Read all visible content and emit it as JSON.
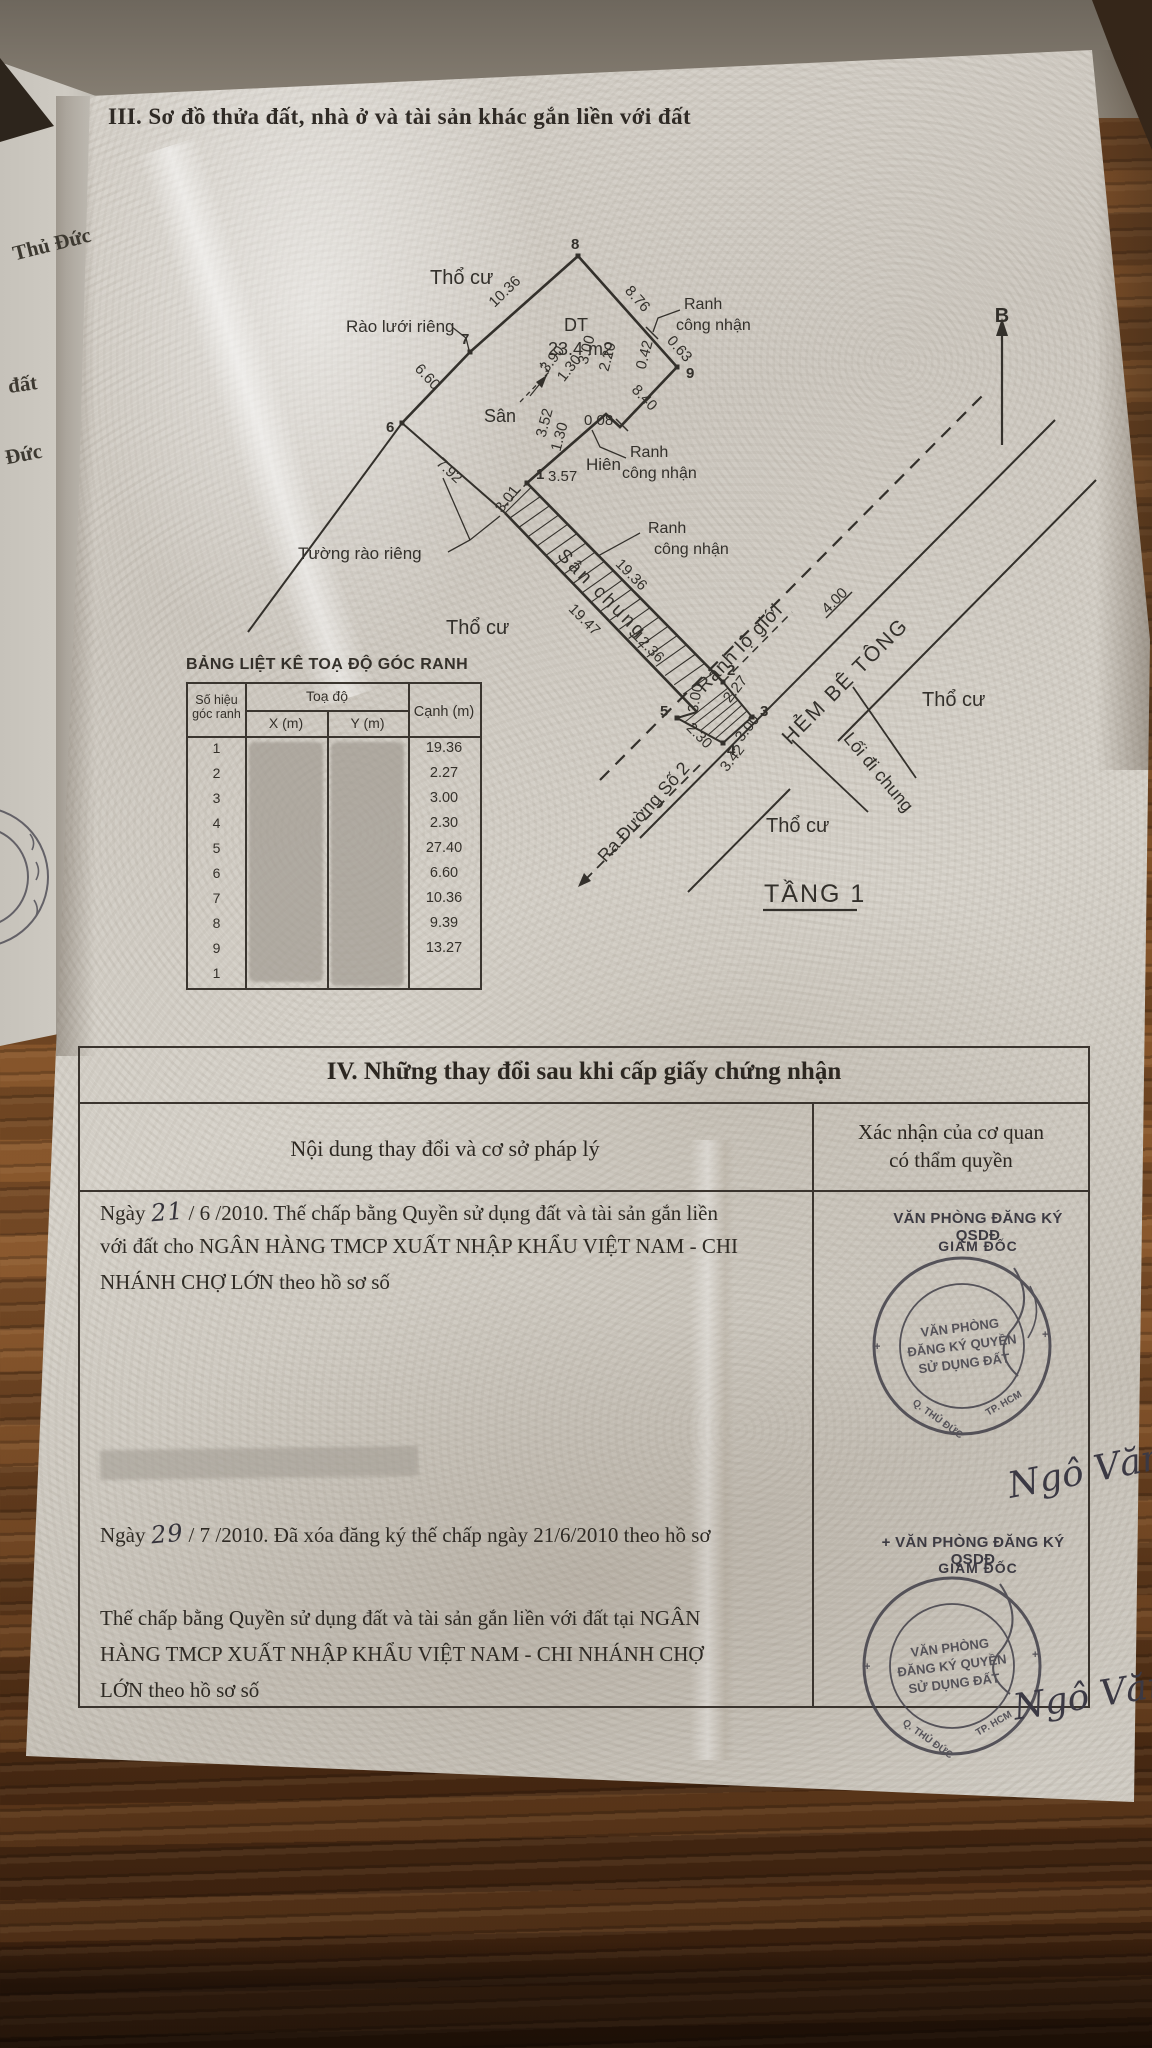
{
  "colors": {
    "ink": "#33302b",
    "paper": "#d6d2ca",
    "stamp_ink": "#45434c",
    "wood": "#7a4a28"
  },
  "section3": {
    "title": "III. Sơ đồ thửa đất, nhà ở và tài sản khác gắn liền với đất"
  },
  "margin": {
    "items": [
      {
        "t": "Thủ Đức"
      },
      {
        "t": "đất"
      },
      {
        "t": "Đức"
      }
    ]
  },
  "diagram": {
    "solid": [
      {
        "p": [
          [
            402,
            423
          ],
          [
            470,
            352
          ],
          [
            578,
            256
          ],
          [
            677,
            367
          ]
        ],
        "w": 2.6
      },
      {
        "p": [
          [
            677,
            367
          ],
          [
            620,
            427
          ],
          [
            606,
            414
          ],
          [
            527,
            483
          ]
        ],
        "w": 2.6
      },
      {
        "p": [
          [
            402,
            423
          ],
          [
            248,
            632
          ]
        ],
        "w": 2
      },
      {
        "p": [
          [
            402,
            423
          ],
          [
            505,
            513
          ]
        ],
        "w": 2
      },
      {
        "p": [
          [
            527,
            483
          ],
          [
            723,
            682
          ]
        ],
        "w": 2.6
      },
      {
        "p": [
          [
            505,
            513
          ],
          [
            697,
            712
          ]
        ],
        "w": 2.6
      },
      {
        "p": [
          [
            723,
            682
          ],
          [
            752,
            717
          ],
          [
            723,
            743
          ],
          [
            677,
            718
          ],
          [
            697,
            712
          ]
        ],
        "w": 2
      },
      {
        "p": [
          [
            640,
            838
          ],
          [
            1055,
            420
          ]
        ],
        "w": 2
      },
      {
        "p": [
          [
            688,
            892
          ],
          [
            790,
            789
          ]
        ],
        "w": 2
      },
      {
        "p": [
          [
            838,
            741
          ],
          [
            1096,
            480
          ]
        ],
        "w": 2
      },
      {
        "p": [
          [
            853,
            687
          ],
          [
            916,
            778
          ]
        ],
        "w": 1.8
      },
      {
        "p": [
          [
            792,
            740
          ],
          [
            868,
            812
          ]
        ],
        "w": 1.8
      },
      {
        "p": [
          [
            763,
            910
          ],
          [
            857,
            910
          ]
        ],
        "w": 2.2
      },
      {
        "p": [
          [
            646,
            327
          ],
          [
            658,
            339
          ]
        ],
        "w": 1.5
      },
      {
        "p": [
          [
            616,
            419
          ],
          [
            628,
            431
          ]
        ],
        "w": 1.5
      },
      {
        "p": [
          [
            826,
            618
          ],
          [
            852,
            592
          ]
        ],
        "w": 1.5
      },
      {
        "p": [
          [
            452,
            327
          ],
          [
            466,
            338
          ],
          [
            469,
            350
          ]
        ],
        "w": 1.3
      },
      {
        "p": [
          [
            448,
            552
          ],
          [
            470,
            540
          ],
          [
            500,
            516
          ]
        ],
        "w": 1.3
      },
      {
        "p": [
          [
            470,
            540
          ],
          [
            443,
            478
          ]
        ],
        "w": 1.3
      },
      {
        "p": [
          [
            680,
            310
          ],
          [
            658,
            318
          ],
          [
            653,
            332
          ]
        ],
        "w": 1.3
      },
      {
        "p": [
          [
            626,
            458
          ],
          [
            600,
            447
          ],
          [
            592,
            430
          ]
        ],
        "w": 1.3
      },
      {
        "p": [
          [
            640,
            533
          ],
          [
            598,
            556
          ],
          [
            586,
            544
          ]
        ],
        "w": 1.3
      },
      {
        "p": [
          [
            1002,
            445
          ],
          [
            1002,
            330
          ]
        ],
        "w": 2.2
      },
      {
        "p": [
          [
            530,
            396
          ],
          [
            547,
            375
          ]
        ],
        "w": 1.2
      },
      {
        "p": [
          [
            728,
            688
          ],
          [
            685,
            722
          ]
        ],
        "w": 1.1
      },
      {
        "p": [
          [
            733,
            694
          ],
          [
            692,
            726
          ]
        ],
        "w": 1.1
      },
      {
        "p": [
          [
            738,
            700
          ],
          [
            700,
            731
          ]
        ],
        "w": 1.1
      },
      {
        "p": [
          [
            742,
            705
          ],
          [
            708,
            735
          ]
        ],
        "w": 1.1
      },
      {
        "p": [
          [
            747,
            711
          ],
          [
            715,
            739
          ]
        ],
        "w": 1.1
      }
    ],
    "dashed": [
      {
        "p": [
          [
            600,
            780
          ],
          [
            985,
            393
          ]
        ],
        "w": 2.2,
        "d": "13 9"
      },
      {
        "p": [
          [
            585,
            880
          ],
          [
            700,
            765
          ]
        ],
        "w": 1.8,
        "d": "10 7"
      },
      {
        "p": [
          [
            723,
            682
          ],
          [
            792,
            612
          ]
        ],
        "w": 1.5,
        "d": "8 6"
      },
      {
        "p": [
          [
            520,
            402
          ],
          [
            549,
            372
          ]
        ],
        "w": 1.3,
        "d": "5 4"
      },
      {
        "p": [
          [
            549,
            372
          ],
          [
            540,
            363
          ]
        ],
        "w": 1.3,
        "d": "5 4"
      },
      {
        "p": [
          [
            527,
            483
          ],
          [
            503,
            508
          ]
        ],
        "w": 1.5,
        "d": "5 4"
      }
    ],
    "arrows": [
      [
        [
          1002,
          318
        ],
        [
          996,
          336
        ],
        [
          1008,
          336
        ]
      ],
      [
        [
          578,
          887
        ],
        [
          591,
          881
        ],
        [
          584,
          873
        ]
      ],
      [
        [
          547,
          375
        ],
        [
          542,
          388
        ],
        [
          536,
          382
        ]
      ]
    ],
    "hatch": {
      "upper": [
        527,
        483
      ],
      "lower": [
        505,
        513
      ],
      "dir": [
        0.702,
        0.713
      ],
      "start": 6,
      "end": 272,
      "step": 13,
      "skew": 12,
      "w": 1.1
    },
    "points": [
      [
        527,
        483
      ],
      [
        723,
        682
      ],
      [
        752,
        717
      ],
      [
        723,
        743
      ],
      [
        677,
        718
      ],
      [
        402,
        423
      ],
      [
        470,
        352
      ],
      [
        578,
        256
      ],
      [
        677,
        367
      ]
    ],
    "labels": [
      {
        "t": "Thổ cư",
        "x": 430,
        "y": 284,
        "s": 20
      },
      {
        "t": "Thổ cư",
        "x": 446,
        "y": 634,
        "s": 20
      },
      {
        "t": "Thổ cư",
        "x": 922,
        "y": 706,
        "s": 20
      },
      {
        "t": "Thổ cư",
        "x": 766,
        "y": 832,
        "s": 20
      },
      {
        "t": "Sân",
        "x": 484,
        "y": 422,
        "s": 18
      },
      {
        "t": "Hiên",
        "x": 586,
        "y": 470,
        "s": 17
      },
      {
        "t": "DT",
        "x": 564,
        "y": 331,
        "s": 18
      },
      {
        "t": "23.4 m2",
        "x": 548,
        "y": 355,
        "s": 18
      },
      {
        "t": "TẦNG 1",
        "x": 764,
        "y": 902,
        "s": 25,
        "w": 2
      },
      {
        "t": "Rào lưới riêng",
        "x": 346,
        "y": 332,
        "s": 17
      },
      {
        "t": "Tường rào riêng",
        "x": 298,
        "y": 559,
        "s": 17
      },
      {
        "t": "Ranh",
        "x": 684,
        "y": 309,
        "s": 16
      },
      {
        "t": "công nhận",
        "x": 676,
        "y": 330,
        "s": 16
      },
      {
        "t": "Ranh",
        "x": 630,
        "y": 457,
        "s": 16
      },
      {
        "t": "công nhận",
        "x": 622,
        "y": 478,
        "s": 16
      },
      {
        "t": "Ranh",
        "x": 648,
        "y": 533,
        "s": 16
      },
      {
        "t": "công nhận",
        "x": 654,
        "y": 554,
        "s": 16
      },
      {
        "t": "Ranh lộ giới",
        "x": 744,
        "y": 652,
        "s": 19,
        "r": -46,
        "a": "m",
        "w": 1
      },
      {
        "t": "HẺM BÊ TÔNG",
        "x": 850,
        "y": 686,
        "s": 21,
        "r": -45,
        "a": "m",
        "w": 2
      },
      {
        "t": "Lối đi chung",
        "x": 874,
        "y": 776,
        "s": 18,
        "r": 50,
        "a": "m"
      },
      {
        "t": "Ra Đường Số 2",
        "x": 648,
        "y": 816,
        "s": 18,
        "r": -48,
        "a": "m"
      },
      {
        "t": "Sân chung",
        "x": 598,
        "y": 598,
        "s": 19,
        "r": 45,
        "a": "m",
        "w": 3
      },
      {
        "t": "B",
        "x": 1002,
        "y": 322,
        "s": 20,
        "b": 1,
        "a": "m"
      },
      {
        "t": "10.36",
        "x": 508,
        "y": 295,
        "r": -44,
        "a": "m"
      },
      {
        "t": "8.76",
        "x": 634,
        "y": 302,
        "r": 48,
        "a": "m"
      },
      {
        "t": "0.63",
        "x": 676,
        "y": 352,
        "r": 48,
        "a": "m"
      },
      {
        "t": "6.60",
        "x": 424,
        "y": 380,
        "r": 47,
        "a": "m"
      },
      {
        "t": "7.92",
        "x": 446,
        "y": 474,
        "r": 43,
        "a": "m"
      },
      {
        "t": "8.40",
        "x": 641,
        "y": 401,
        "r": 46,
        "a": "m"
      },
      {
        "t": "0.08",
        "x": 584,
        "y": 425,
        "s": 15
      },
      {
        "t": "3.52",
        "x": 549,
        "y": 424,
        "r": -75,
        "a": "m"
      },
      {
        "t": "1.30",
        "x": 564,
        "y": 438,
        "r": -75,
        "a": "m"
      },
      {
        "t": "3.57",
        "x": 548,
        "y": 481,
        "s": 15
      },
      {
        "t": "3.01",
        "x": 511,
        "y": 502,
        "r": -52,
        "a": "m"
      },
      {
        "t": "3.90",
        "x": 556,
        "y": 362,
        "r": -52,
        "a": "m"
      },
      {
        "t": "1.30",
        "x": 573,
        "y": 371,
        "r": -52,
        "a": "m"
      },
      {
        "t": "3.00",
        "x": 591,
        "y": 351,
        "r": -75,
        "a": "m"
      },
      {
        "t": "2.20",
        "x": 612,
        "y": 358,
        "r": -75,
        "a": "m"
      },
      {
        "t": "0.42",
        "x": 649,
        "y": 356,
        "r": -75,
        "a": "m"
      },
      {
        "t": "19.36",
        "x": 628,
        "y": 578,
        "r": 45,
        "a": "m"
      },
      {
        "t": "19.47",
        "x": 581,
        "y": 623,
        "r": 45,
        "a": "m"
      },
      {
        "t": "12.36",
        "x": 645,
        "y": 650,
        "r": 45,
        "a": "m"
      },
      {
        "t": "2.27",
        "x": 739,
        "y": 692,
        "r": -52,
        "a": "m"
      },
      {
        "t": "3.00",
        "x": 751,
        "y": 731,
        "r": -52,
        "a": "m"
      },
      {
        "t": "3.00",
        "x": 700,
        "y": 699,
        "r": -80,
        "a": "m"
      },
      {
        "t": "2.30",
        "x": 696,
        "y": 739,
        "r": 45,
        "a": "m"
      },
      {
        "t": "3.42",
        "x": 736,
        "y": 761,
        "r": -52,
        "a": "m"
      },
      {
        "t": "4.00",
        "x": 838,
        "y": 604,
        "r": -45,
        "a": "m"
      },
      {
        "t": "1",
        "x": 536,
        "y": 479,
        "b": 1
      },
      {
        "t": "2",
        "x": 727,
        "y": 675,
        "b": 1
      },
      {
        "t": "3",
        "x": 760,
        "y": 716,
        "b": 1
      },
      {
        "t": "4",
        "x": 727,
        "y": 755,
        "b": 1
      },
      {
        "t": "5",
        "x": 660,
        "y": 716,
        "b": 1
      },
      {
        "t": "6",
        "x": 386,
        "y": 432,
        "b": 1
      },
      {
        "t": "7",
        "x": 461,
        "y": 344,
        "b": 1
      },
      {
        "t": "8",
        "x": 571,
        "y": 249,
        "b": 1
      },
      {
        "t": "9",
        "x": 686,
        "y": 378,
        "b": 1
      }
    ]
  },
  "coord_table": {
    "title": "BẢNG LIỆT KÊ TOẠ ĐỘ GÓC RANH",
    "col_point_1": "Số hiệu",
    "col_point_2": "góc ranh",
    "col_group": "Toạ độ",
    "col_x": "X (m)",
    "col_y": "Y (m)",
    "col_edge": "Cạnh (m)",
    "rows": [
      {
        "n": "1",
        "v": "19.36"
      },
      {
        "n": "2",
        "v": "2.27"
      },
      {
        "n": "3",
        "v": "3.00"
      },
      {
        "n": "4",
        "v": "2.30"
      },
      {
        "n": "5",
        "v": "27.40"
      },
      {
        "n": "6",
        "v": "6.60"
      },
      {
        "n": "7",
        "v": "10.36"
      },
      {
        "n": "8",
        "v": "9.39"
      },
      {
        "n": "9",
        "v": "13.27"
      },
      {
        "n": "1",
        "v": ""
      }
    ]
  },
  "section4": {
    "title": "IV. Những thay đổi sau khi cấp giấy chứng nhận",
    "col_left": "Nội dung thay đổi và cơ sở pháp lý",
    "col_right_1": "Xác nhận của cơ quan",
    "col_right_2": "có thẩm quyền",
    "entries": [
      {
        "top": 1198,
        "lines": [
          [
            {
              "t": "Ngày "
            },
            {
              "t": "21",
              "hw": true
            },
            {
              "t": " / 6 /2010. Thế chấp bằng Quyền sử dụng đất và tài sản gắn liền"
            }
          ],
          [
            {
              "t": "với đất cho NGÂN HÀNG TMCP XUẤT NHẬP KHẨU VIỆT NAM - CHI"
            }
          ],
          [
            {
              "t": "NHÁNH CHỢ LỚN  theo hồ sơ số"
            }
          ]
        ]
      },
      {
        "top": 1520,
        "lines": [
          [
            {
              "t": "Ngày "
            },
            {
              "t": "29",
              "hw": true
            },
            {
              "t": "  / 7 /2010. Đã xóa đăng ký thế chấp ngày 21/6/2010 theo hồ sơ"
            }
          ]
        ]
      },
      {
        "top": 1606,
        "lines": [
          [
            {
              "t": "Thế chấp bằng Quyền sử dụng đất và tài sản gắn liền  với đất tại NGÂN"
            }
          ],
          [
            {
              "t": "HÀNG TMCP XUẤT NHẬP KHẨU VIỆT NAM - CHI NHÁNH CHỢ"
            }
          ],
          [
            {
              "t": "LỚN theo hồ sơ số"
            }
          ]
        ]
      }
    ],
    "stamp_head_1": "VĂN PHÒNG ĐĂNG KÝ QSDĐ",
    "stamp_head_2": "+ VĂN PHÒNG ĐĂNG KÝ QSDĐ",
    "stamp_sub": "GIÁM ĐỐC",
    "stamp": {
      "line1": "VĂN PHÒNG",
      "line2": "ĐĂNG KÝ QUYỀN",
      "line3": "SỬ DỤNG ĐẤT",
      "arc_left": "Q. THỦ ĐỨC",
      "arc_right": "TP. HCM"
    },
    "signature": "Ngô Văn Bình"
  }
}
